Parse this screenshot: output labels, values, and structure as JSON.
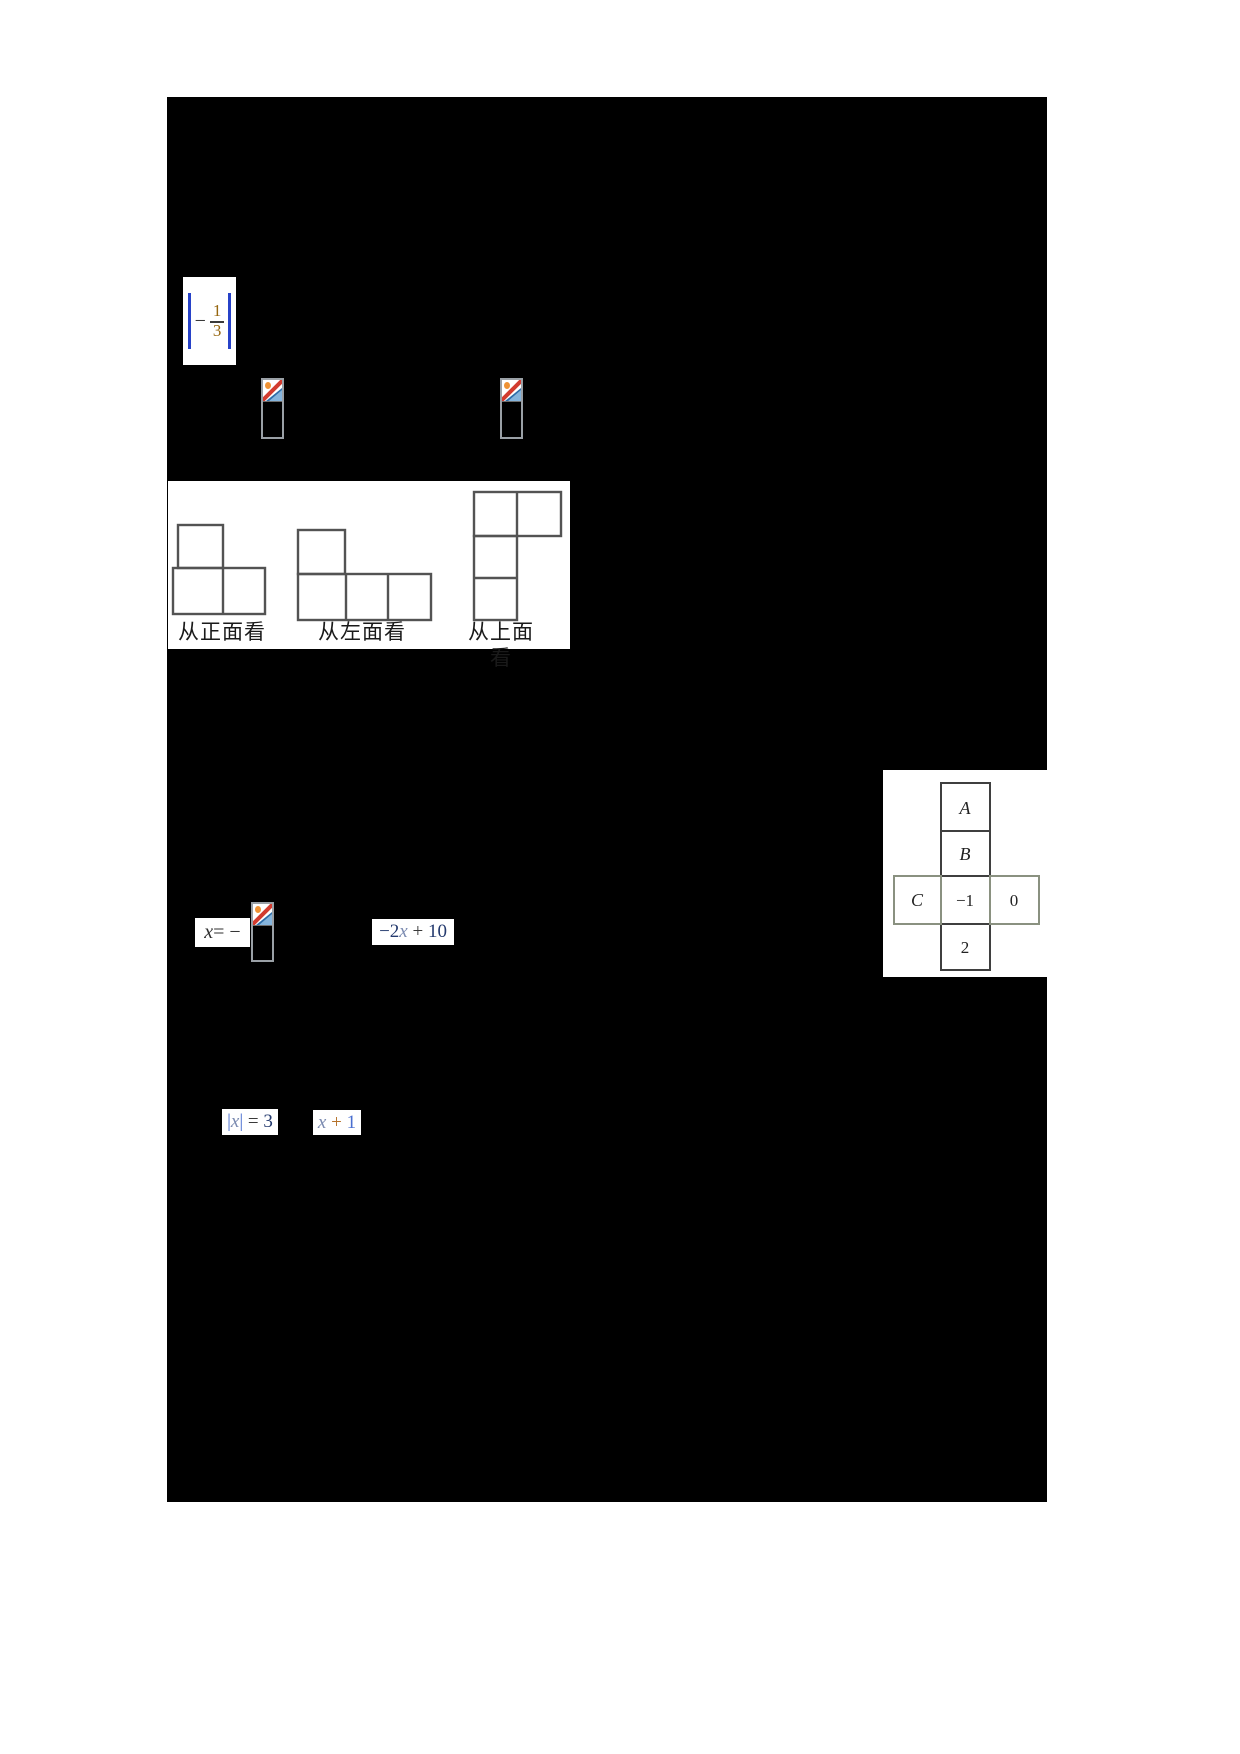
{
  "document": {
    "kind": "math worksheet page",
    "page_bg": "#000000",
    "canvas_bg": "#ffffff"
  },
  "colors": {
    "abs_bar_blue": "#2742c8",
    "digit_amber": "#96660f",
    "equation_navy": "#243a6e",
    "x_gray_blue": "#7a8ab0",
    "one_blue": "#4a6fd0",
    "plus_orange": "#b5722a",
    "figure_stroke": "#3c3c3c",
    "net_dark_border": "#3f3f3f",
    "net_light_border": "#8a9180",
    "placeholder_border": "#9aa0a6",
    "slash_red": "#d23b2f",
    "mountain_blue_light": "#85b4dc",
    "mountain_blue_dark": "#2d6da8",
    "sun_orange": "#ef9234"
  },
  "equations": {
    "abs_fraction": {
      "left_bar": "|",
      "minus": "−",
      "numerator": "1",
      "denominator": "3",
      "right_bar": "|"
    },
    "x_equals": {
      "x": "x",
      "rest": "= −"
    },
    "linear_expr": {
      "coef": "−2",
      "x": "x",
      "plus": " + ",
      "const": "10"
    },
    "abs_eq": {
      "left_bar": "|",
      "x": "x",
      "right_bar": "|",
      "equals": " = ",
      "value": "3"
    },
    "x_plus_one": {
      "x": "x",
      "plus": " + ",
      "one": "1"
    }
  },
  "view_figures": {
    "front_label": "从正面看",
    "left_label": "从左面看",
    "top_label": "从上面看"
  },
  "cube_net": {
    "top": "A",
    "upper": "B",
    "left": "C",
    "center": "−1",
    "right": "0",
    "bottom": "2"
  }
}
